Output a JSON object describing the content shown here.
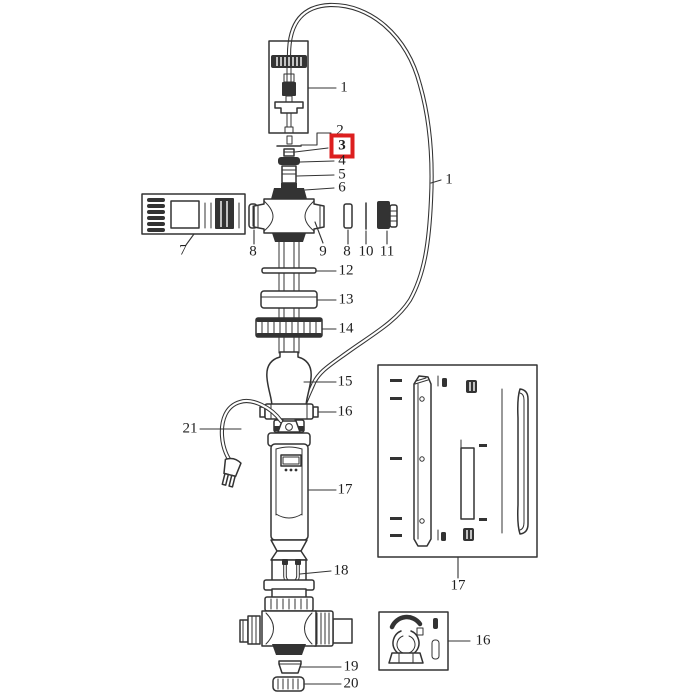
{
  "figure": {
    "kind": "exploded-parts-diagram",
    "background": "#ffffff",
    "line_color": "#333333",
    "highlight": {
      "color": "#dc1f1f",
      "highlighted_part": "3"
    }
  },
  "callouts": {
    "n1_top": "1",
    "n2": "2",
    "n3": "3",
    "n4": "4",
    "n5": "5",
    "n6": "6",
    "n7": "7",
    "n8_left": "8",
    "n9": "9",
    "n8_right": "8",
    "n10": "10",
    "n11": "11",
    "n1_cable": "1",
    "n12": "12",
    "n13": "13",
    "n14": "14",
    "n15": "15",
    "n16_main": "16",
    "n21": "21",
    "n17_main": "17",
    "n18": "18",
    "n19": "19",
    "n20": "20",
    "n17_box": "17",
    "n16_box": "16"
  }
}
